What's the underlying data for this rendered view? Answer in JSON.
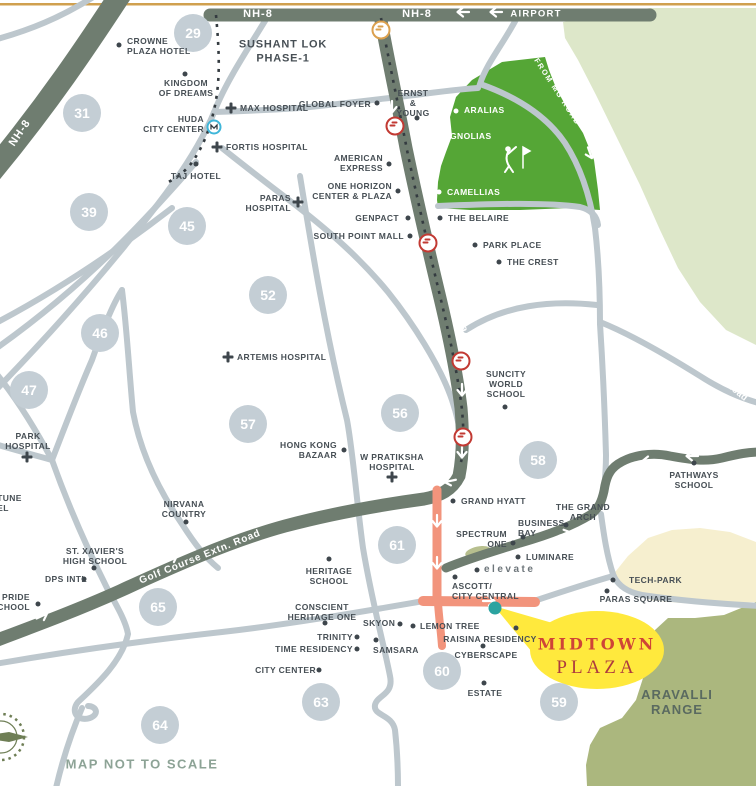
{
  "map": {
    "note": "MAP NOT TO SCALE",
    "highlight_name": "MIDTOWN PLAZA"
  },
  "colors": {
    "major_road": "#6f7d70",
    "minor_road": "#bdc7cd",
    "access_road_orange": "#f2947c",
    "golf_green": "#55a636",
    "pale_green": "#dde7c9",
    "aravalli_green": "#abb77e",
    "tech_zone_cream": "#f6efcf",
    "sector_circle": "#c4ced5",
    "label_text": "#474f55",
    "highlight_yellow": "#ffe93d",
    "highlight_red": "#cf4437",
    "location_teal": "#2ba3a0",
    "metro_red": "#c23a33",
    "metro_orange": "#dba04e",
    "huda_metro_blue": "#3fb6d9",
    "top_border_gold": "#d0a04f"
  },
  "road_labels": [
    {
      "t": "NH-8",
      "x": 258,
      "y": 14,
      "rot": 0,
      "size": 11,
      "ls": 1
    },
    {
      "t": "NH-8",
      "x": 417,
      "y": 14,
      "rot": 0,
      "size": 11,
      "ls": 1
    },
    {
      "t": "AIRPORT",
      "x": 536,
      "y": 14,
      "rot": 0,
      "size": 9.5,
      "ls": 1.2
    },
    {
      "t": "NH-8",
      "x": 20,
      "y": 133,
      "rot": -56,
      "size": 11,
      "ls": 1
    },
    {
      "t": "Golf Course Road",
      "x": 452,
      "y": 288,
      "rot": 74,
      "size": 10.5,
      "ls": 1.2
    },
    {
      "t": "Golf Course Extn. Road",
      "x": 200,
      "y": 557,
      "rot": -22,
      "size": 10,
      "ls": 0.8
    },
    {
      "t": "Gurgaon-Faridabad Road",
      "x": 700,
      "y": 362,
      "rot": 39,
      "size": 9,
      "ls": 0.5
    },
    {
      "t": "FROM MG ROAD",
      "x": 557,
      "y": 92,
      "rot": 57,
      "size": 7.5,
      "ls": 1.5
    }
  ],
  "sectors": [
    {
      "n": "29",
      "x": 193,
      "y": 33
    },
    {
      "n": "31",
      "x": 82,
      "y": 113
    },
    {
      "n": "39",
      "x": 89,
      "y": 212
    },
    {
      "n": "45",
      "x": 187,
      "y": 226
    },
    {
      "n": "46",
      "x": 100,
      "y": 333
    },
    {
      "n": "47",
      "x": 29,
      "y": 390
    },
    {
      "n": "52",
      "x": 268,
      "y": 295
    },
    {
      "n": "56",
      "x": 400,
      "y": 413
    },
    {
      "n": "57",
      "x": 248,
      "y": 424
    },
    {
      "n": "58",
      "x": 538,
      "y": 460
    },
    {
      "n": "61",
      "x": 397,
      "y": 545
    },
    {
      "n": "65",
      "x": 158,
      "y": 607
    },
    {
      "n": "60",
      "x": 442,
      "y": 671
    },
    {
      "n": "63",
      "x": 321,
      "y": 702
    },
    {
      "n": "64",
      "x": 160,
      "y": 725
    },
    {
      "n": "59",
      "x": 559,
      "y": 702
    }
  ],
  "labels": [
    {
      "lines": [
        "CROWNE",
        "PLAZA HOTEL"
      ],
      "x": 127,
      "y": 46,
      "a": "l"
    },
    {
      "lines": [
        "KINGDOM",
        "OF DREAMS"
      ],
      "x": 186,
      "y": 88,
      "a": "c"
    },
    {
      "lines": [
        "HUDA",
        "CITY CENTER"
      ],
      "x": 204,
      "y": 124,
      "a": "r"
    },
    {
      "lines": [
        "MAX HOSPITAL"
      ],
      "x": 240,
      "y": 108,
      "a": "l"
    },
    {
      "lines": [
        "FORTIS HOSPITAL"
      ],
      "x": 226,
      "y": 147,
      "a": "l"
    },
    {
      "lines": [
        "TAJ HOTEL"
      ],
      "x": 196,
      "y": 176,
      "a": "c"
    },
    {
      "lines": [
        "SUSHANT LOK",
        "PHASE-1"
      ],
      "x": 283,
      "y": 52,
      "a": "c",
      "cls": "big"
    },
    {
      "lines": [
        "GLOBAL FOYER"
      ],
      "x": 371,
      "y": 104,
      "a": "r"
    },
    {
      "lines": [
        "ERNST",
        "&",
        "YOUNG"
      ],
      "x": 413,
      "y": 103,
      "a": "c"
    },
    {
      "lines": [
        "ARALIAS"
      ],
      "x": 464,
      "y": 110,
      "a": "l",
      "cls": "wht"
    },
    {
      "lines": [
        "MAGNOLIAS"
      ],
      "x": 436,
      "y": 136,
      "a": "l",
      "cls": "wht"
    },
    {
      "lines": [
        "CAMELLIAS"
      ],
      "x": 447,
      "y": 192,
      "a": "l",
      "cls": "wht"
    },
    {
      "lines": [
        "AMERICAN",
        "EXPRESS"
      ],
      "x": 383,
      "y": 163,
      "a": "r"
    },
    {
      "lines": [
        "ONE HORIZON",
        "CENTER & PLAZA"
      ],
      "x": 392,
      "y": 191,
      "a": "r"
    },
    {
      "lines": [
        "PARAS",
        "HOSPITAL"
      ],
      "x": 291,
      "y": 203,
      "a": "r"
    },
    {
      "lines": [
        "GENPACT"
      ],
      "x": 399,
      "y": 218,
      "a": "r"
    },
    {
      "lines": [
        "SOUTH POINT MALL"
      ],
      "x": 404,
      "y": 236,
      "a": "r"
    },
    {
      "lines": [
        "THE BELAIRE"
      ],
      "x": 448,
      "y": 218,
      "a": "l"
    },
    {
      "lines": [
        "PARK PLACE"
      ],
      "x": 483,
      "y": 245,
      "a": "l"
    },
    {
      "lines": [
        "THE CREST"
      ],
      "x": 507,
      "y": 262,
      "a": "l"
    },
    {
      "lines": [
        "ARTEMIS HOSPITAL"
      ],
      "x": 237,
      "y": 357,
      "a": "l"
    },
    {
      "lines": [
        "SUNCITY",
        "WORLD",
        "SCHOOL"
      ],
      "x": 506,
      "y": 384,
      "a": "c"
    },
    {
      "lines": [
        "PATHWAYS",
        "SCHOOL"
      ],
      "x": 694,
      "y": 480,
      "a": "c"
    },
    {
      "lines": [
        "PARK",
        "HOSPITAL"
      ],
      "x": 28,
      "y": 441,
      "a": "c"
    },
    {
      "lines": [
        "FORTUNE",
        "HOTEL"
      ],
      "x": -22,
      "y": 503,
      "a": "l"
    },
    {
      "lines": [
        "NIRVANA",
        "COUNTRY"
      ],
      "x": 184,
      "y": 509,
      "a": "c"
    },
    {
      "lines": [
        "ST. XAVIER'S",
        "HIGH SCHOOL"
      ],
      "x": 95,
      "y": 556,
      "a": "c"
    },
    {
      "lines": [
        "DPS INTL"
      ],
      "x": 45,
      "y": 579,
      "a": "l"
    },
    {
      "lines": [
        "'S PRIDE",
        "SCHOOL"
      ],
      "x": 30,
      "y": 602,
      "a": "r"
    },
    {
      "lines": [
        "HONG KONG",
        "BAZAAR"
      ],
      "x": 337,
      "y": 450,
      "a": "r"
    },
    {
      "lines": [
        "W PRATIKSHA",
        "HOSPITAL"
      ],
      "x": 392,
      "y": 462,
      "a": "c"
    },
    {
      "lines": [
        "GRAND HYATT"
      ],
      "x": 461,
      "y": 501,
      "a": "l"
    },
    {
      "lines": [
        "THE GRAND",
        "ARCH"
      ],
      "x": 583,
      "y": 512,
      "a": "c"
    },
    {
      "lines": [
        "BUSINESS",
        "BAY"
      ],
      "x": 518,
      "y": 528,
      "a": "l"
    },
    {
      "lines": [
        "SPECTRUM",
        "ONE"
      ],
      "x": 507,
      "y": 539,
      "a": "r"
    },
    {
      "lines": [
        "LUMINARE"
      ],
      "x": 526,
      "y": 557,
      "a": "l"
    },
    {
      "lines": [
        "elevate"
      ],
      "x": 484,
      "y": 570,
      "a": "l",
      "cls": "elev"
    },
    {
      "lines": [
        "ASCOTT/",
        "CITY CENTRAL"
      ],
      "x": 452,
      "y": 591,
      "a": "l"
    },
    {
      "lines": [
        "HERITAGE",
        "SCHOOL"
      ],
      "x": 329,
      "y": 576,
      "a": "c"
    },
    {
      "lines": [
        "CONSCIENT",
        "HERITAGE ONE"
      ],
      "x": 322,
      "y": 612,
      "a": "c"
    },
    {
      "lines": [
        "TRINITY"
      ],
      "x": 353,
      "y": 637,
      "a": "r"
    },
    {
      "lines": [
        "TIME RESIDENCY"
      ],
      "x": 353,
      "y": 649,
      "a": "r"
    },
    {
      "lines": [
        "SAMSARA"
      ],
      "x": 373,
      "y": 650,
      "a": "l"
    },
    {
      "lines": [
        "CITY CENTER"
      ],
      "x": 316,
      "y": 670,
      "a": "r"
    },
    {
      "lines": [
        "SKYON"
      ],
      "x": 363,
      "y": 623,
      "a": "l"
    },
    {
      "lines": [
        "LEMON TREE"
      ],
      "x": 420,
      "y": 626,
      "a": "l"
    },
    {
      "lines": [
        "RAISINA RESIDENCY"
      ],
      "x": 490,
      "y": 639,
      "a": "c"
    },
    {
      "lines": [
        "CYBERSCAPE"
      ],
      "x": 486,
      "y": 655,
      "a": "c"
    },
    {
      "lines": [
        "ESTATE"
      ],
      "x": 485,
      "y": 693,
      "a": "c"
    },
    {
      "lines": [
        "TECH-PARK"
      ],
      "x": 629,
      "y": 580,
      "a": "l"
    },
    {
      "lines": [
        "PARAS SQUARE"
      ],
      "x": 636,
      "y": 599,
      "a": "c"
    },
    {
      "lines": [
        "MIDTOWN"
      ],
      "x": 597,
      "y": 645,
      "a": "c",
      "cls": "midtown",
      "name": "midtown-plaza-title"
    },
    {
      "lines": [
        "PLAZA"
      ],
      "x": 597,
      "y": 668,
      "a": "c",
      "cls": "plaza",
      "name": "midtown-plaza-subtitle"
    },
    {
      "lines": [
        "ARAVALLI",
        "RANGE"
      ],
      "x": 677,
      "y": 703,
      "a": "c",
      "cls": "aravalli",
      "name": "aravalli-range-label"
    },
    {
      "lines": [
        "MAP NOT TO SCALE"
      ],
      "x": 142,
      "y": 764,
      "a": "c",
      "cls": "note",
      "name": "map-scale-note"
    }
  ],
  "markers": [
    {
      "type": "dot",
      "x": 119,
      "y": 45
    },
    {
      "type": "dot",
      "x": 185,
      "y": 74
    },
    {
      "type": "metro-blue",
      "x": 214,
      "y": 127,
      "name": "huda-metro-icon"
    },
    {
      "type": "cross",
      "x": 231,
      "y": 108
    },
    {
      "type": "cross",
      "x": 217,
      "y": 147
    },
    {
      "type": "dot",
      "x": 196,
      "y": 164
    },
    {
      "type": "dot",
      "x": 377,
      "y": 103
    },
    {
      "type": "dot",
      "x": 417,
      "y": 118
    },
    {
      "type": "dotw",
      "x": 456,
      "y": 111
    },
    {
      "type": "dotw",
      "x": 428,
      "y": 136
    },
    {
      "type": "dotw",
      "x": 439,
      "y": 192
    },
    {
      "type": "dot",
      "x": 389,
      "y": 164
    },
    {
      "type": "dot",
      "x": 398,
      "y": 191
    },
    {
      "type": "cross",
      "x": 298,
      "y": 202
    },
    {
      "type": "dot",
      "x": 408,
      "y": 218
    },
    {
      "type": "dot",
      "x": 410,
      "y": 236
    },
    {
      "type": "dot",
      "x": 440,
      "y": 218
    },
    {
      "type": "dot",
      "x": 475,
      "y": 245
    },
    {
      "type": "dot",
      "x": 499,
      "y": 262
    },
    {
      "type": "cross",
      "x": 228,
      "y": 357
    },
    {
      "type": "dot",
      "x": 505,
      "y": 407
    },
    {
      "type": "dot",
      "x": 694,
      "y": 463
    },
    {
      "type": "cross",
      "x": 27,
      "y": 457
    },
    {
      "type": "dot",
      "x": 186,
      "y": 522
    },
    {
      "type": "dot",
      "x": 94,
      "y": 568
    },
    {
      "type": "dot",
      "x": 84,
      "y": 579
    },
    {
      "type": "dot",
      "x": 38,
      "y": 604
    },
    {
      "type": "dot",
      "x": 344,
      "y": 450
    },
    {
      "type": "cross",
      "x": 392,
      "y": 477
    },
    {
      "type": "dot",
      "x": 453,
      "y": 501
    },
    {
      "type": "dot",
      "x": 566,
      "y": 525
    },
    {
      "type": "dot",
      "x": 523,
      "y": 537
    },
    {
      "type": "dot",
      "x": 513,
      "y": 543
    },
    {
      "type": "dot",
      "x": 518,
      "y": 557
    },
    {
      "type": "dot",
      "x": 477,
      "y": 570
    },
    {
      "type": "dot",
      "x": 455,
      "y": 577
    },
    {
      "type": "dot",
      "x": 329,
      "y": 559
    },
    {
      "type": "dot",
      "x": 325,
      "y": 623
    },
    {
      "type": "dot",
      "x": 357,
      "y": 637
    },
    {
      "type": "dot",
      "x": 357,
      "y": 649
    },
    {
      "type": "dot",
      "x": 376,
      "y": 640
    },
    {
      "type": "dot",
      "x": 319,
      "y": 670
    },
    {
      "type": "dot",
      "x": 400,
      "y": 624
    },
    {
      "type": "dot",
      "x": 413,
      "y": 626
    },
    {
      "type": "dot",
      "x": 516,
      "y": 628
    },
    {
      "type": "dot",
      "x": 483,
      "y": 646
    },
    {
      "type": "dot",
      "x": 484,
      "y": 683
    },
    {
      "type": "dot",
      "x": 613,
      "y": 580
    },
    {
      "type": "dot",
      "x": 607,
      "y": 591
    },
    {
      "type": "metro-orange",
      "x": 381,
      "y": 30,
      "name": "metro-station-icon"
    },
    {
      "type": "metro-red",
      "x": 395,
      "y": 126,
      "name": "metro-station-icon"
    },
    {
      "type": "metro-red",
      "x": 428,
      "y": 243,
      "name": "metro-station-icon"
    },
    {
      "type": "metro-red",
      "x": 461,
      "y": 361,
      "name": "metro-station-icon"
    },
    {
      "type": "metro-red",
      "x": 463,
      "y": 437,
      "name": "metro-station-icon"
    },
    {
      "type": "teal",
      "x": 495,
      "y": 608,
      "name": "midtown-plaza-location-dot"
    }
  ]
}
